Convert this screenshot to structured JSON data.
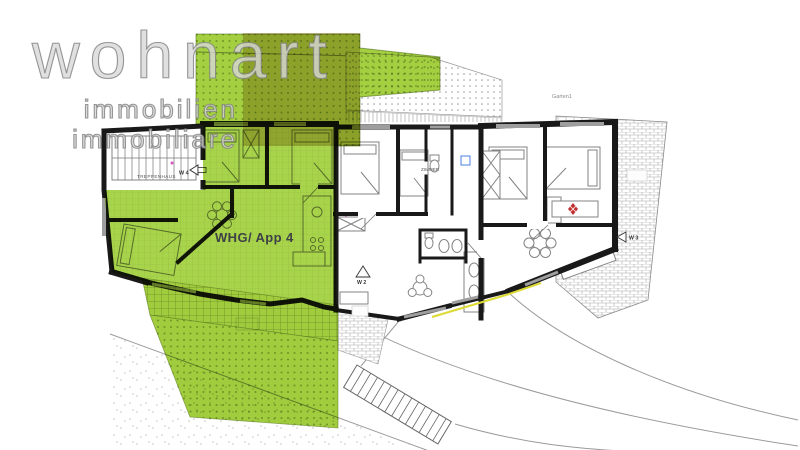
{
  "logo": {
    "brand": "wohnart",
    "tagline_de": "immobilien",
    "tagline_it": "immobiliare"
  },
  "plan": {
    "apartment_label": "WHG/ App 4",
    "rooms": {
      "staircase": "TREPPENHAUS",
      "bedroom": "ZIMMER"
    },
    "site": {
      "garden": "Garten1"
    },
    "units": {
      "w4": "W 4",
      "w3": "W 3",
      "w2": "W 2"
    }
  },
  "colors": {
    "apartment_green": "#a8d44c",
    "garden_green": "#a4cf41",
    "lawn_green": "#a0cc3e",
    "overlay_beige": "#d9c79e",
    "wall_black": "#191919",
    "logo_gray": "#b5b5b5",
    "stove_red": "#c23232",
    "appliance_blue": "#4a7fe0",
    "edge_yellow": "#ddda35"
  }
}
